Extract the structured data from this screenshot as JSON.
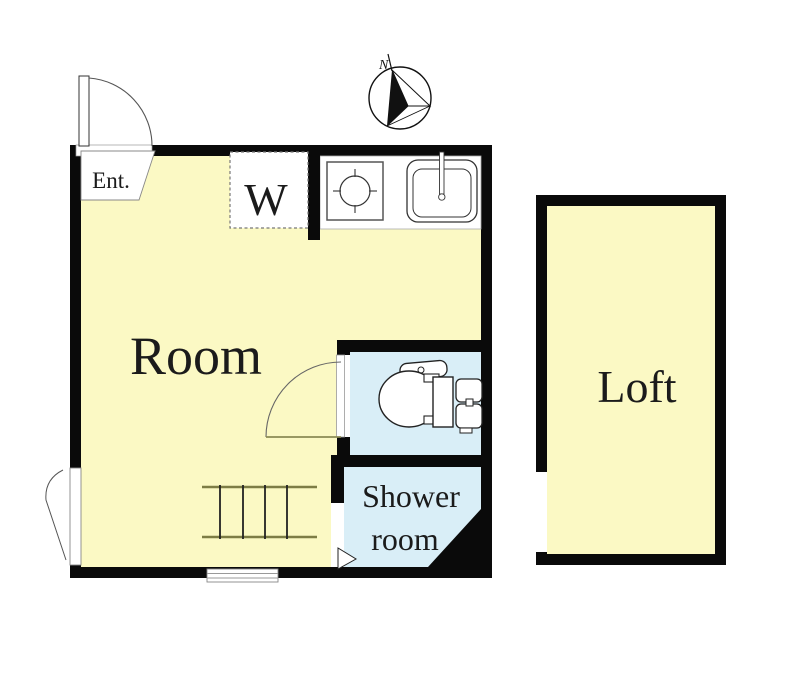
{
  "plan": {
    "type": "apartment-floor-plan",
    "labels": {
      "entrance": "Ent.",
      "washer": "W",
      "room": "Room",
      "shower_line1": "Shower",
      "shower_line2": "room",
      "loft": "Loft",
      "compass_north": "N"
    },
    "colors": {
      "wall": "#0a0a0a",
      "floor_yellow": "#FBF9C4",
      "wet_area_blue": "#D9EEF7",
      "fixture_white": "#ffffff",
      "door_leaf_olive": "#8b8b55",
      "ladder_rail_olive": "#7d7d45",
      "background": "#ffffff"
    },
    "icons": [
      "north-compass-icon",
      "entrance-door-swing-icon",
      "stove-burner-icon",
      "kitchen-sink-icon",
      "washing-machine-space-icon",
      "toilet-icon",
      "toilet-door-swing-icon",
      "loft-ladder-icon",
      "window-icon",
      "shower-door-arrow-icon",
      "left-window-swing-icon"
    ]
  }
}
